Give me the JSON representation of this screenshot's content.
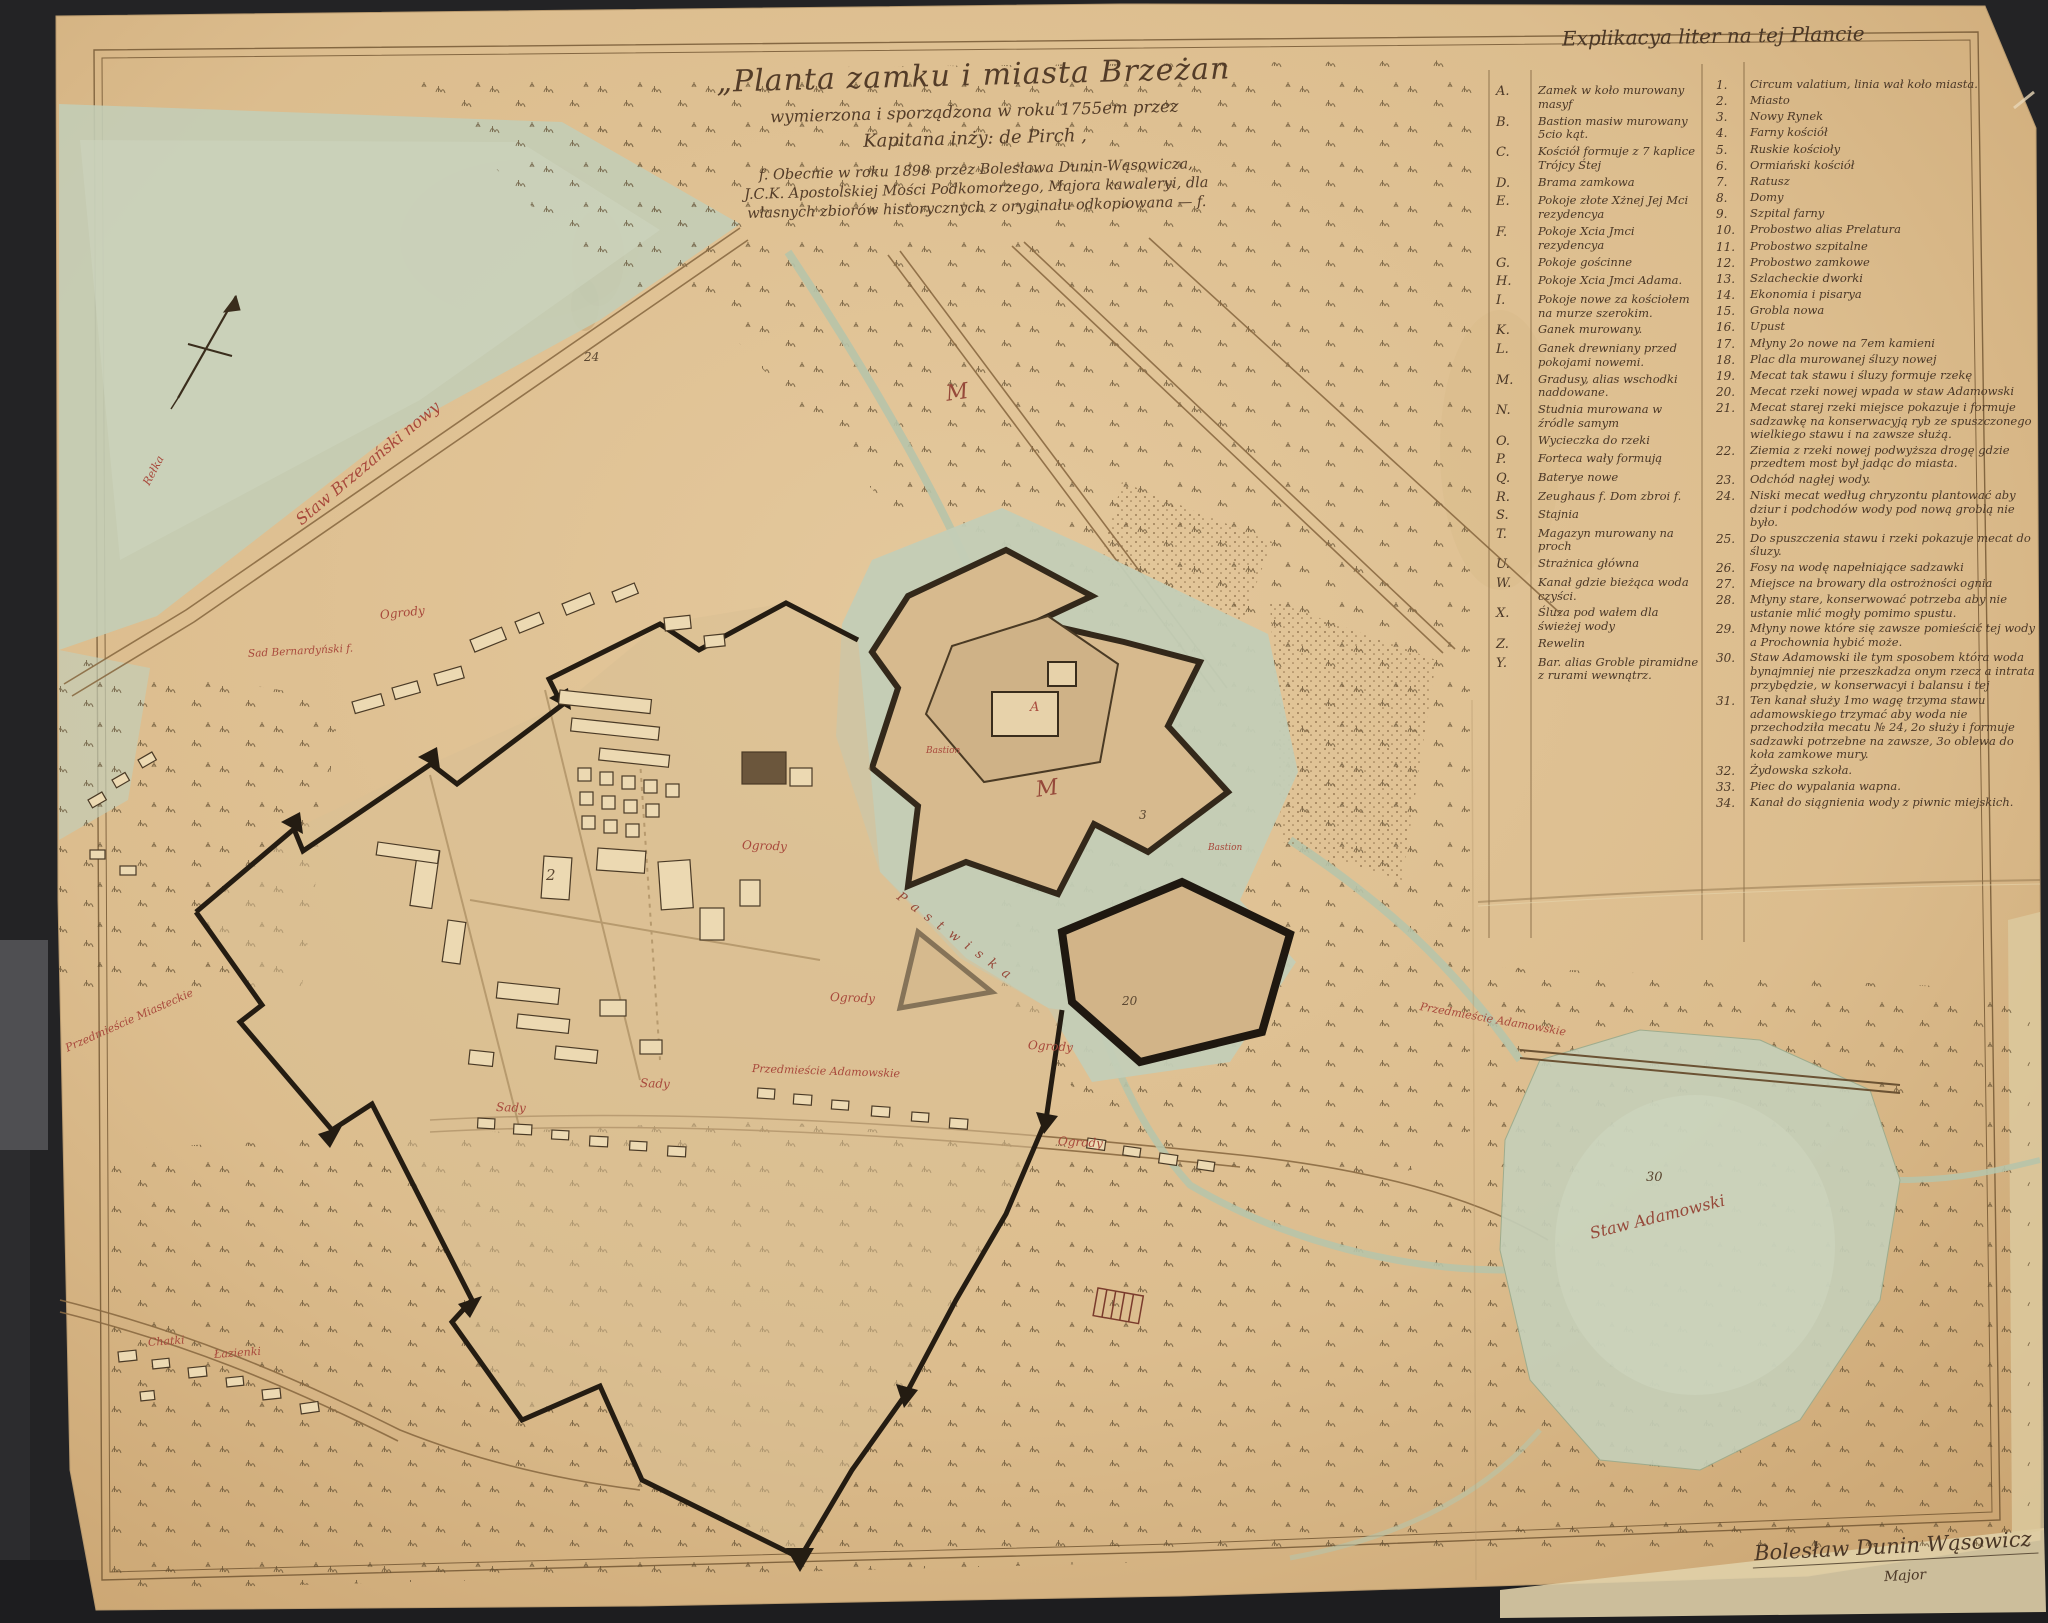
{
  "colors": {
    "background": "#232325",
    "paper": "#dcbf93",
    "water": "#c3cdb6",
    "ink": "#4a3726",
    "red_label": "#a8493c",
    "wall": "#241c12"
  },
  "title_block": {
    "line1": "„Planta zamku i miasta Brzeżan",
    "line2": "wymierzona i sporządzona w roku 1755em przez",
    "line3": "Kapitana inży: de Pirch ,",
    "line4": "f. Obecnie w roku 1898 przez Bolesława Dunin-Wąsowicza,",
    "line5": "J.C.K. Apostolskiej Mości Podkomorzego, Majora kawaleryi, dla",
    "line6": "własnych zbiorów historycznych z oryginału odkopiowana — f."
  },
  "legend": {
    "title": "Explikacya liter na tej Plancie",
    "letters": [
      {
        "key": "A.",
        "text": "Zamek w koło murowany masyf"
      },
      {
        "key": "B.",
        "text": "Bastion masiw murowany 5cio kąt."
      },
      {
        "key": "C.",
        "text": "Kościół formuje z 7 kaplice Trójcy Śtej"
      },
      {
        "key": "D.",
        "text": "Brama zamkowa"
      },
      {
        "key": "E.",
        "text": "Pokoje złote Xżnej Jej Mci rezydencya"
      },
      {
        "key": "F.",
        "text": "Pokoje Xcia Jmci rezydencya"
      },
      {
        "key": "G.",
        "text": "Pokoje gościnne"
      },
      {
        "key": "H.",
        "text": "Pokoje Xcia Jmci Adama."
      },
      {
        "key": "I.",
        "text": "Pokoje nowe za kościołem na murze szerokim."
      },
      {
        "key": "K.",
        "text": "Ganek murowany."
      },
      {
        "key": "L.",
        "text": "Ganek drewniany przed pokojami nowemi."
      },
      {
        "key": "M.",
        "text": "Gradusy, alias wschodki naddowane."
      },
      {
        "key": "N.",
        "text": "Studnia murowana w źródle samym"
      },
      {
        "key": "O.",
        "text": "Wycieczka do rzeki"
      },
      {
        "key": "P.",
        "text": "Forteca wały formują"
      },
      {
        "key": "Q.",
        "text": "Baterye nowe"
      },
      {
        "key": "R.",
        "text": "Zeughaus f. Dom zbroi f."
      },
      {
        "key": "S.",
        "text": "Stajnia"
      },
      {
        "key": "T.",
        "text": "Magazyn murowany na proch"
      },
      {
        "key": "U.",
        "text": "Strażnica główna"
      },
      {
        "key": "W.",
        "text": "Kanał gdzie bieżąca woda czyści."
      },
      {
        "key": "X.",
        "text": "Śluza pod wałem dla świeżej wody"
      },
      {
        "key": "Z.",
        "text": "Rewelin"
      },
      {
        "key": "Y.",
        "text": "Bar. alias Groble piramidne z rurami wewnątrz."
      }
    ],
    "numbers": [
      {
        "key": "1.",
        "text": "Circum valatium, linia wał koło miasta."
      },
      {
        "key": "2.",
        "text": "Miasto"
      },
      {
        "key": "3.",
        "text": "Nowy Rynek"
      },
      {
        "key": "4.",
        "text": "Farny kościół"
      },
      {
        "key": "5.",
        "text": "Ruskie kościoły"
      },
      {
        "key": "6.",
        "text": "Ormiański kościół"
      },
      {
        "key": "7.",
        "text": "Ratusz"
      },
      {
        "key": "8.",
        "text": "Domy"
      },
      {
        "key": "9.",
        "text": "Szpital farny"
      },
      {
        "key": "10.",
        "text": "Probostwo alias Prelatura"
      },
      {
        "key": "11.",
        "text": "Probostwo szpitalne"
      },
      {
        "key": "12.",
        "text": "Probostwo zamkowe"
      },
      {
        "key": "13.",
        "text": "Szlacheckie dworki"
      },
      {
        "key": "14.",
        "text": "Ekonomia i pisarya"
      },
      {
        "key": "15.",
        "text": "Grobla nowa"
      },
      {
        "key": "16.",
        "text": "Upust"
      },
      {
        "key": "17.",
        "text": "Młyny 2o nowe na 7em kamieni"
      },
      {
        "key": "18.",
        "text": "Plac dla murowanej śluzy nowej"
      },
      {
        "key": "19.",
        "text": "Mecat tak stawu i śluzy formuje rzekę"
      },
      {
        "key": "20.",
        "text": "Mecat rzeki nowej wpada w staw Adamowski"
      },
      {
        "key": "21.",
        "text": "Mecat starej rzeki miejsce pokazuje i formuje sadzawkę na konserwacyją ryb ze spuszczonego wielkiego stawu i na zawsze służą."
      },
      {
        "key": "22.",
        "text": "Ziemia z rzeki nowej podwyższa drogę gdzie przedtem most był jadąc do miasta."
      },
      {
        "key": "23.",
        "text": "Odchód nagłej wody."
      },
      {
        "key": "24.",
        "text": "Niski mecat według chryzontu plantować aby dziur i podchodów wody pod nową groblą nie było."
      },
      {
        "key": "25.",
        "text": "Do spuszczenia stawu i rzeki pokazuje mecat do śluzy."
      },
      {
        "key": "26.",
        "text": "Fosy na wodę napełniające sadzawki"
      },
      {
        "key": "27.",
        "text": "Miejsce na browary dla ostrożności ognia"
      },
      {
        "key": "28.",
        "text": "Młyny stare, konserwować potrzeba aby nie ustanie mlić mogły pomimo spustu."
      },
      {
        "key": "29.",
        "text": "Młyny nowe które się zawsze pomieścić tej wody a Prochownia hybić może."
      },
      {
        "key": "30.",
        "text": "Staw Adamowski ile tym sposobem która woda bynajmniej nie przeszkadza onym rzecz a intrata przybędzie, w konserwacyi i balansu i tej"
      },
      {
        "key": "31.",
        "text": "Ten kanał służy 1mo wagę trzyma stawu adamowskiego trzymać aby woda nie przechodziła mecatu № 24, 2o służy i formuje sadzawki potrzebne na zawsze, 3o oblewa do koła zamkowe mury."
      },
      {
        "key": "32.",
        "text": "Żydowska szkoła."
      },
      {
        "key": "33.",
        "text": "Piec do wypalania wapna."
      },
      {
        "key": "34.",
        "text": "Kanał do siągnienia wody z piwnic miejskich."
      }
    ]
  },
  "labels": [
    {
      "text": "Staw Brzezański nowy",
      "x": 298,
      "y": 512,
      "rot": -40,
      "size": 16,
      "color": "#a8493c"
    },
    {
      "text": "Rełka",
      "x": 146,
      "y": 478,
      "rot": -62,
      "size": 11,
      "color": "#a8493c"
    },
    {
      "text": "Ogrody",
      "x": 380,
      "y": 608,
      "rot": -6,
      "size": 12,
      "color": "#a8493c"
    },
    {
      "text": "Sad Bernardyński f.",
      "x": 248,
      "y": 648,
      "rot": -3,
      "size": 10.5,
      "color": "#a8493c"
    },
    {
      "text": "Ogrody",
      "x": 742,
      "y": 838,
      "rot": 2,
      "size": 12,
      "color": "#a8493c"
    },
    {
      "text": "Ogrody",
      "x": 830,
      "y": 990,
      "rot": 2,
      "size": 12,
      "color": "#a8493c"
    },
    {
      "text": "Ogrody",
      "x": 1028,
      "y": 1038,
      "rot": 3,
      "size": 12,
      "color": "#a8493c"
    },
    {
      "text": "Ogrody",
      "x": 1058,
      "y": 1134,
      "rot": 3,
      "size": 12,
      "color": "#a8493c"
    },
    {
      "text": "Sady",
      "x": 496,
      "y": 1100,
      "rot": 2,
      "size": 12,
      "color": "#a8493c"
    },
    {
      "text": "Sady",
      "x": 640,
      "y": 1076,
      "rot": 2,
      "size": 12,
      "color": "#a8493c"
    },
    {
      "text": "Przedmieście Adamowskie",
      "x": 752,
      "y": 1062,
      "rot": 2,
      "size": 11,
      "color": "#a8493c"
    },
    {
      "text": "Przedmieście Adamowskie",
      "x": 1420,
      "y": 1000,
      "rot": 10,
      "size": 11,
      "color": "#a8493c"
    },
    {
      "text": "Przedmieście Miasteckie",
      "x": 66,
      "y": 1042,
      "rot": -24,
      "size": 11,
      "color": "#a8493c"
    },
    {
      "text": "Chatki",
      "x": 148,
      "y": 1336,
      "rot": -4,
      "size": 11,
      "color": "#a8493c"
    },
    {
      "text": "Łazienki",
      "x": 214,
      "y": 1348,
      "rot": -4,
      "size": 11,
      "color": "#a8493c"
    },
    {
      "text": "Staw Adamowski",
      "x": 1590,
      "y": 1224,
      "rot": -14,
      "size": 16,
      "color": "#96493a"
    },
    {
      "text": "Pastwiska",
      "x": 898,
      "y": 888,
      "rot": 36,
      "size": 13,
      "color": "#96493a",
      "ls": 9
    },
    {
      "text": "M",
      "x": 946,
      "y": 382,
      "rot": -8,
      "size": 22,
      "color": "#96493a"
    },
    {
      "text": "M",
      "x": 1036,
      "y": 778,
      "rot": -8,
      "size": 22,
      "color": "#96493a"
    },
    {
      "text": "Bastion",
      "x": 926,
      "y": 746,
      "rot": 0,
      "size": 9,
      "color": "#a8493c"
    },
    {
      "text": "Bastion",
      "x": 1208,
      "y": 843,
      "rot": 0,
      "size": 9,
      "color": "#a8493c"
    },
    {
      "text": "A",
      "x": 1030,
      "y": 700,
      "rot": 0,
      "size": 13,
      "color": "#a8493c"
    },
    {
      "text": "2",
      "x": 546,
      "y": 866,
      "rot": 0,
      "size": 15,
      "color": "#5a4630"
    },
    {
      "text": "24",
      "x": 584,
      "y": 350,
      "rot": 0,
      "size": 12,
      "color": "#5a4630"
    },
    {
      "text": "20",
      "x": 1122,
      "y": 994,
      "rot": 0,
      "size": 12,
      "color": "#5a4630"
    },
    {
      "text": "3",
      "x": 1139,
      "y": 808,
      "rot": 0,
      "size": 12,
      "color": "#5a4630"
    },
    {
      "text": "30",
      "x": 1646,
      "y": 1170,
      "rot": 0,
      "size": 13,
      "color": "#5a4630"
    }
  ],
  "signature": {
    "name": "Bolesław Dunin Wąsowicz",
    "rank": "Major"
  }
}
